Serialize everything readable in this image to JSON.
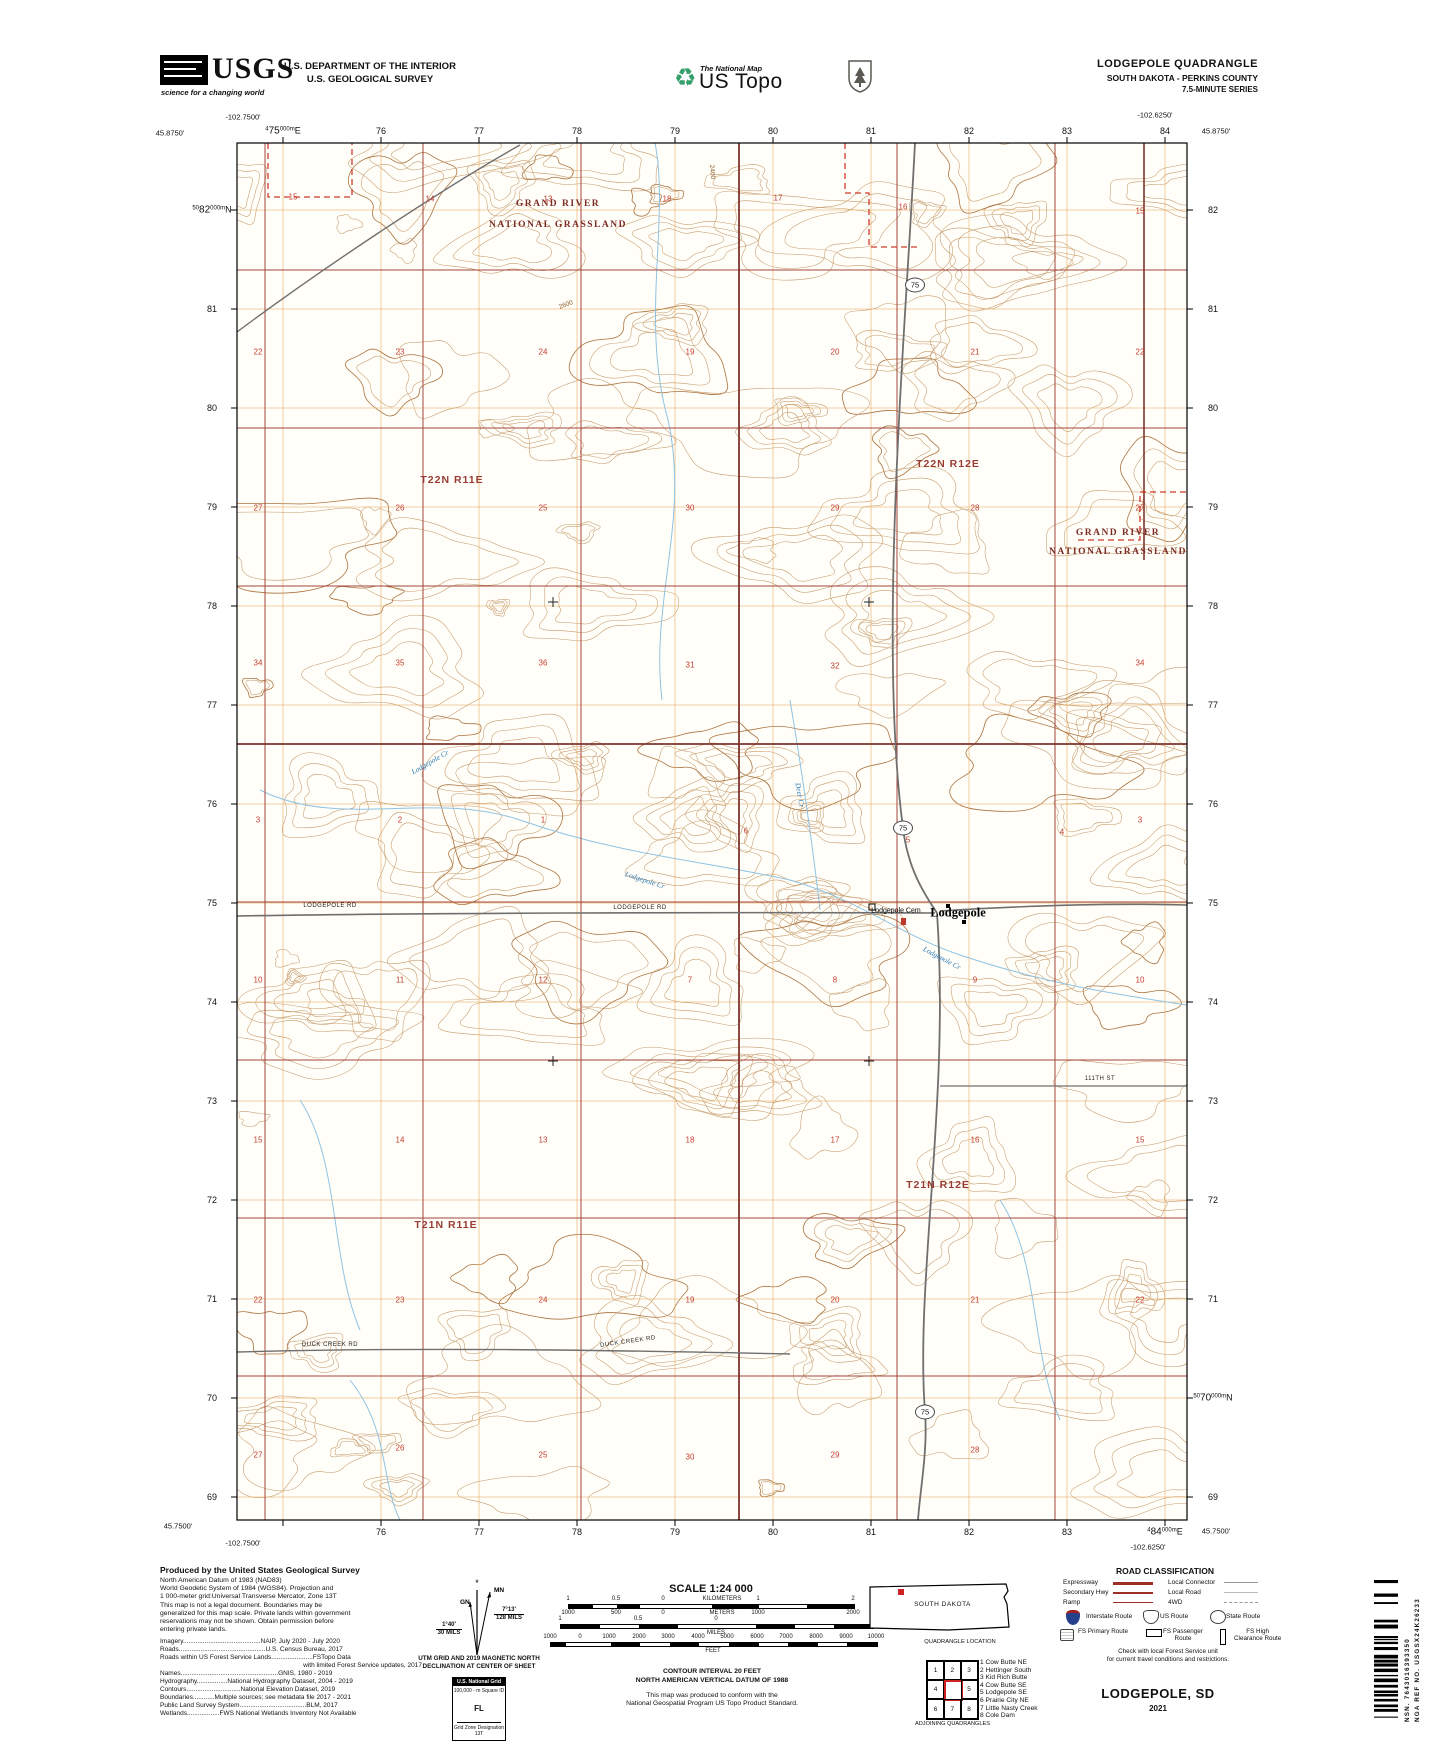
{
  "header": {
    "usgs_word": "USGS",
    "usgs_tagline": "science for a changing world",
    "dept_line1": "U.S. DEPARTMENT OF THE INTERIOR",
    "dept_line2": "U.S. GEOLOGICAL SURVEY",
    "tnm_small": "The National Map",
    "ustopo": "US Topo",
    "quad_title": "LODGEPOLE QUADRANGLE",
    "quad_subtitle": "SOUTH DAKOTA - PERKINS COUNTY",
    "quad_series": "7.5-MINUTE SERIES"
  },
  "map": {
    "corner_coords": [
      {
        "t": "-102.7500'",
        "x": 243,
        "y": 117
      },
      {
        "t": "45.8750'",
        "x": 170,
        "y": 133
      },
      {
        "t": "-102.6250'",
        "x": 1155,
        "y": 115
      },
      {
        "t": "45.8750'",
        "x": 1216,
        "y": 131
      },
      {
        "t": "45.7500'",
        "x": 178,
        "y": 1526
      },
      {
        "t": "-102.7500'",
        "x": 243,
        "y": 1543
      },
      {
        "t": "-102.6250'",
        "x": 1148,
        "y": 1547
      },
      {
        "t": "45.7500'",
        "x": 1216,
        "y": 1531
      }
    ],
    "eastings": {
      "xs": [
        283,
        381,
        479,
        577,
        675,
        773,
        871,
        969,
        1067,
        1165
      ],
      "top": [
        {
          "pre": "4",
          "big": "75",
          "mid": "000m",
          "suf": "E"
        },
        "76",
        "77",
        "78",
        "79",
        "80",
        "81",
        "82",
        "83",
        "84"
      ],
      "bottom": [
        null,
        "76",
        "77",
        "78",
        "79",
        "80",
        "81",
        "82",
        "83",
        {
          "pre": "4",
          "big": "84",
          "mid": "000m",
          "suf": "E"
        }
      ]
    },
    "northings": {
      "ys": [
        210,
        309,
        408,
        507,
        606,
        705,
        804,
        903,
        1002,
        1101,
        1200,
        1299,
        1398,
        1497
      ],
      "left": [
        {
          "pre": "50",
          "big": "82",
          "mid": "000m",
          "suf": "N"
        },
        "81",
        "80",
        "79",
        "78",
        "77",
        "76",
        "75",
        "74",
        "73",
        "72",
        "71",
        "70",
        "69"
      ],
      "right": [
        "82",
        "81",
        "80",
        "79",
        "78",
        "77",
        "76",
        "75",
        "74",
        "73",
        "72",
        "71",
        {
          "pre": "50",
          "big": "70",
          "mid": "000m",
          "suf": "N"
        },
        "69"
      ]
    },
    "township_labels": [
      {
        "t": "T22N R11E",
        "x": 452,
        "y": 480
      },
      {
        "t": "T22N R12E",
        "x": 948,
        "y": 464
      },
      {
        "t": "T21N R11E",
        "x": 446,
        "y": 1225
      },
      {
        "t": "T21N R12E",
        "x": 938,
        "y": 1185
      }
    ],
    "grassland_labels": [
      {
        "t": "GRAND RIVER",
        "x": 558,
        "y": 204
      },
      {
        "t": "NATIONAL GRASSLAND",
        "x": 558,
        "y": 225
      },
      {
        "t": "GRAND RIVER",
        "x": 1118,
        "y": 533
      },
      {
        "t": "NATIONAL GRASSLAND",
        "x": 1118,
        "y": 552
      }
    ],
    "place_labels": [
      {
        "t": "Lodgepole",
        "x": 958,
        "y": 913,
        "cls": "town"
      },
      {
        "t": "Lodgepole Cem",
        "x": 896,
        "y": 911,
        "cls": "feat"
      }
    ],
    "road_labels": [
      {
        "t": "LODGEPOLE RD",
        "x": 330,
        "y": 906
      },
      {
        "t": "LODGEPOLE RD",
        "x": 640,
        "y": 908
      },
      {
        "t": "DUCK CREEK RD",
        "x": 330,
        "y": 1345
      },
      {
        "t": "DUCK CREEK RD",
        "x": 628,
        "y": 1342,
        "rot": -8
      },
      {
        "t": "111TH ST",
        "x": 1100,
        "y": 1079
      }
    ],
    "stream_labels": [
      {
        "t": "Lodgepole Cr",
        "x": 430,
        "y": 762,
        "rot": -30
      },
      {
        "t": "Lodgepole Cr",
        "x": 645,
        "y": 880,
        "rot": 18
      },
      {
        "t": "Lodgepole Cr",
        "x": 942,
        "y": 958,
        "rot": 28
      },
      {
        "t": "Deer Cr",
        "x": 800,
        "y": 795,
        "rot": 80
      }
    ],
    "elevation_labels": [
      {
        "t": "2400",
        "x": 712,
        "y": 172,
        "rot": 85
      },
      {
        "t": "2600",
        "x": 566,
        "y": 305,
        "rot": -20
      }
    ],
    "route_shields": [
      {
        "t": "75",
        "x": 915,
        "y": 285
      },
      {
        "t": "75",
        "x": 903,
        "y": 828
      },
      {
        "t": "75",
        "x": 925,
        "y": 1412
      }
    ],
    "section_numbers": [
      {
        "t": "15",
        "x": 293,
        "y": 197
      },
      {
        "t": "14",
        "x": 430,
        "y": 199
      },
      {
        "t": "13",
        "x": 548,
        "y": 199
      },
      {
        "t": "18",
        "x": 667,
        "y": 199
      },
      {
        "t": "17",
        "x": 778,
        "y": 198
      },
      {
        "t": "16",
        "x": 903,
        "y": 207
      },
      {
        "t": "15",
        "x": 1140,
        "y": 211
      },
      {
        "t": "22",
        "x": 258,
        "y": 352
      },
      {
        "t": "23",
        "x": 400,
        "y": 352
      },
      {
        "t": "24",
        "x": 543,
        "y": 352
      },
      {
        "t": "19",
        "x": 690,
        "y": 352
      },
      {
        "t": "20",
        "x": 835,
        "y": 352
      },
      {
        "t": "21",
        "x": 975,
        "y": 352
      },
      {
        "t": "22",
        "x": 1140,
        "y": 352
      },
      {
        "t": "27",
        "x": 258,
        "y": 508
      },
      {
        "t": "26",
        "x": 400,
        "y": 508
      },
      {
        "t": "25",
        "x": 543,
        "y": 508
      },
      {
        "t": "30",
        "x": 690,
        "y": 508
      },
      {
        "t": "29",
        "x": 835,
        "y": 508
      },
      {
        "t": "28",
        "x": 975,
        "y": 508
      },
      {
        "t": "27",
        "x": 1140,
        "y": 508
      },
      {
        "t": "34",
        "x": 258,
        "y": 663
      },
      {
        "t": "35",
        "x": 400,
        "y": 663
      },
      {
        "t": "36",
        "x": 543,
        "y": 663
      },
      {
        "t": "31",
        "x": 690,
        "y": 665
      },
      {
        "t": "32",
        "x": 835,
        "y": 666
      },
      {
        "t": "34",
        "x": 1140,
        "y": 663
      },
      {
        "t": "3",
        "x": 258,
        "y": 820
      },
      {
        "t": "2",
        "x": 400,
        "y": 820
      },
      {
        "t": "1",
        "x": 543,
        "y": 820
      },
      {
        "t": "6",
        "x": 746,
        "y": 831
      },
      {
        "t": "5",
        "x": 908,
        "y": 840
      },
      {
        "t": "4",
        "x": 1062,
        "y": 832
      },
      {
        "t": "3",
        "x": 1140,
        "y": 820
      },
      {
        "t": "10",
        "x": 258,
        "y": 980
      },
      {
        "t": "11",
        "x": 400,
        "y": 980
      },
      {
        "t": "12",
        "x": 543,
        "y": 980
      },
      {
        "t": "7",
        "x": 690,
        "y": 980
      },
      {
        "t": "8",
        "x": 835,
        "y": 980
      },
      {
        "t": "9",
        "x": 975,
        "y": 980
      },
      {
        "t": "10",
        "x": 1140,
        "y": 980
      },
      {
        "t": "15",
        "x": 258,
        "y": 1140
      },
      {
        "t": "14",
        "x": 400,
        "y": 1140
      },
      {
        "t": "13",
        "x": 543,
        "y": 1140
      },
      {
        "t": "18",
        "x": 690,
        "y": 1140
      },
      {
        "t": "17",
        "x": 835,
        "y": 1140
      },
      {
        "t": "16",
        "x": 975,
        "y": 1140
      },
      {
        "t": "15",
        "x": 1140,
        "y": 1140
      },
      {
        "t": "22",
        "x": 258,
        "y": 1300
      },
      {
        "t": "23",
        "x": 400,
        "y": 1300
      },
      {
        "t": "24",
        "x": 543,
        "y": 1300
      },
      {
        "t": "19",
        "x": 690,
        "y": 1300
      },
      {
        "t": "20",
        "x": 835,
        "y": 1300
      },
      {
        "t": "21",
        "x": 975,
        "y": 1300
      },
      {
        "t": "22",
        "x": 1140,
        "y": 1300
      },
      {
        "t": "27",
        "x": 258,
        "y": 1455
      },
      {
        "t": "26",
        "x": 400,
        "y": 1448
      },
      {
        "t": "25",
        "x": 543,
        "y": 1455
      },
      {
        "t": "30",
        "x": 690,
        "y": 1457
      },
      {
        "t": "29",
        "x": 835,
        "y": 1455
      },
      {
        "t": "28",
        "x": 975,
        "y": 1450
      }
    ]
  },
  "footer": {
    "credits_title": "Produced by the United States Geological Survey",
    "credits_para": [
      "North American Datum of 1983 (NAD83)",
      "World Geodetic System of 1984 (WGS84).  Projection and",
      "1 000-meter grid:Universal Transverse Mercator, Zone 13T",
      "This map is not a legal document. Boundaries may be",
      "generalized for this map scale. Private lands within government",
      "reservations may not be shown. Obtain permission before",
      "entering private lands."
    ],
    "credit_lines": [
      "Imagery...........................................NAIP,  July 2020 - July 2020",
      "Roads................................................U.S. Census Bureau, 2017",
      "Roads within US Forest Service Lands.......................FSTopo Data",
      "with limited Forest Service updates, 2017",
      "Names......................................................GNIS, 1980 - 2019",
      "Hydrography.................National Hydrography Dataset, 2004 - 2019",
      "Contours..............................National Elevation Dataset, 2019",
      "Boundaries............Multiple sources; see metadata file 2017 - 2021",
      "Public Land Survey System.....................................BLM, 2017",
      "Wetlands..................FWS National Wetlands Inventory Not Available"
    ],
    "declination": {
      "mn": "MN",
      "gn": "GN",
      "star": "*",
      "mn_deg": "7°13'",
      "mn_mils": "128 MILS",
      "gn_deg": "1°40'",
      "gn_mils": "30 MILS",
      "caption1": "UTM GRID AND 2019 MAGNETIC NORTH",
      "caption2": "DECLINATION AT CENTER OF SHEET"
    },
    "usng": {
      "header": "U.S. National Grid",
      "square_id_label": "100,000 - m Square ID",
      "square_id": "FL",
      "zone_label": "Grid Zone Designation",
      "zone": "13T"
    },
    "scale_title": "SCALE 1:24 000",
    "scale_bars": {
      "bar1": {
        "x1": 568,
        "zero": 663,
        "x2": 853,
        "y": 1604,
        "rsegs": 4,
        "lsegs": 4,
        "above": [
          {
            "t": "1",
            "x": 568
          },
          {
            "t": "0.5",
            "x": 616
          },
          {
            "t": "0",
            "x": 663
          },
          {
            "t": "KILOMETERS",
            "x": 722
          },
          {
            "t": "1",
            "x": 758
          },
          {
            "t": "2",
            "x": 853
          }
        ],
        "below": [
          {
            "t": "1000",
            "x": 568
          },
          {
            "t": "500",
            "x": 616
          },
          {
            "t": "0",
            "x": 663
          },
          {
            "t": "METERS",
            "x": 722
          },
          {
            "t": "1000",
            "x": 758
          },
          {
            "t": "2000",
            "x": 853
          }
        ]
      },
      "bar2": {
        "x1": 560,
        "zero": 716,
        "x2": 872,
        "y": 1624,
        "rsegs": 4,
        "lsegs": 4,
        "above": [
          {
            "t": "1",
            "x": 560
          },
          {
            "t": "0.5",
            "x": 638
          },
          {
            "t": "0",
            "x": 716
          },
          {
            "t": "1",
            "x": 872
          }
        ],
        "below": [
          {
            "t": "MILES",
            "x": 716
          }
        ]
      },
      "bar3": {
        "x1": 550,
        "zero": 580,
        "x2": 876,
        "y": 1642,
        "rsegs": 10,
        "lsegs": 2,
        "above": [
          {
            "t": "1000",
            "x": 550
          },
          {
            "t": "0",
            "x": 580
          },
          {
            "t": "1000",
            "x": 609
          },
          {
            "t": "2000",
            "x": 639
          },
          {
            "t": "3000",
            "x": 668
          },
          {
            "t": "4000",
            "x": 698
          },
          {
            "t": "5000",
            "x": 727
          },
          {
            "t": "6000",
            "x": 757
          },
          {
            "t": "7000",
            "x": 786
          },
          {
            "t": "8000",
            "x": 816
          },
          {
            "t": "9000",
            "x": 846
          },
          {
            "t": "10000",
            "x": 876
          }
        ],
        "below": [
          {
            "t": "FEET",
            "x": 713
          }
        ]
      }
    },
    "contour_note1": "CONTOUR INTERVAL 20 FEET",
    "contour_note2": "NORTH AMERICAN VERTICAL DATUM OF 1988",
    "conform_note1": "This map was produced to conform with the",
    "conform_note2": "National Geospatial Program US Topo Product Standard.",
    "state_name": "SOUTH DAKOTA",
    "quad_location_caption": "QUADRANGLE LOCATION",
    "adjoining_caption": "ADJOINING QUADRANGLES",
    "adjoining_cells": [
      "1",
      "2",
      "3",
      "4",
      "",
      "5",
      "6",
      "7",
      "8"
    ],
    "adjoining_list": [
      "1 Cow Butte NE",
      "2 Hettinger South",
      "3 Kid Rich Butte",
      "4 Cow Butte SE",
      "5 Lodgepole SE",
      "6 Prairie City NE",
      "7 Little Nasty Creek",
      "8 Cole Dam"
    ],
    "road_class": {
      "title": "ROAD CLASSIFICATION",
      "left_rows": [
        {
          "t": "Expressway",
          "style": "red-thick"
        },
        {
          "t": "Secondary Hwy",
          "style": "red-med"
        },
        {
          "t": "Ramp",
          "style": "red-thin"
        }
      ],
      "right_rows": [
        {
          "t": "Local Connector",
          "style": "gray"
        },
        {
          "t": "Local Road",
          "style": "gray-thin"
        },
        {
          "t": "4WD",
          "style": "dash"
        }
      ],
      "shield_rows": [
        {
          "t": "Interstate Route",
          "icon": "interstate"
        },
        {
          "t": "US Route",
          "icon": "us"
        },
        {
          "t": "State Route",
          "icon": "state"
        }
      ],
      "fs_rows": [
        {
          "t": "FS Primary Route",
          "icon": "fs-primary"
        },
        {
          "t": "FS Passenger\nRoute",
          "icon": "fs-passenger"
        },
        {
          "t": "FS High\nClearance Route",
          "icon": "fs-high"
        }
      ],
      "note1": "Check with local Forest Service unit",
      "note2": "for current travel conditions and restrictions."
    }
  },
  "sheet": {
    "title": "LODGEPOLE,  SD",
    "year": "2021",
    "nsn": "NSN. 7643016393350",
    "nga": "NGA REF NO. USGSX24K26233"
  },
  "colors": {
    "contour": "#c59a6b",
    "utm_grid": "#e2a24c",
    "section_line": "#a3453c",
    "township_line": "#7e342e",
    "boundary_dash": "#cf3b2b",
    "stream": "#8fc3e2",
    "road": "#6f6f6f"
  }
}
